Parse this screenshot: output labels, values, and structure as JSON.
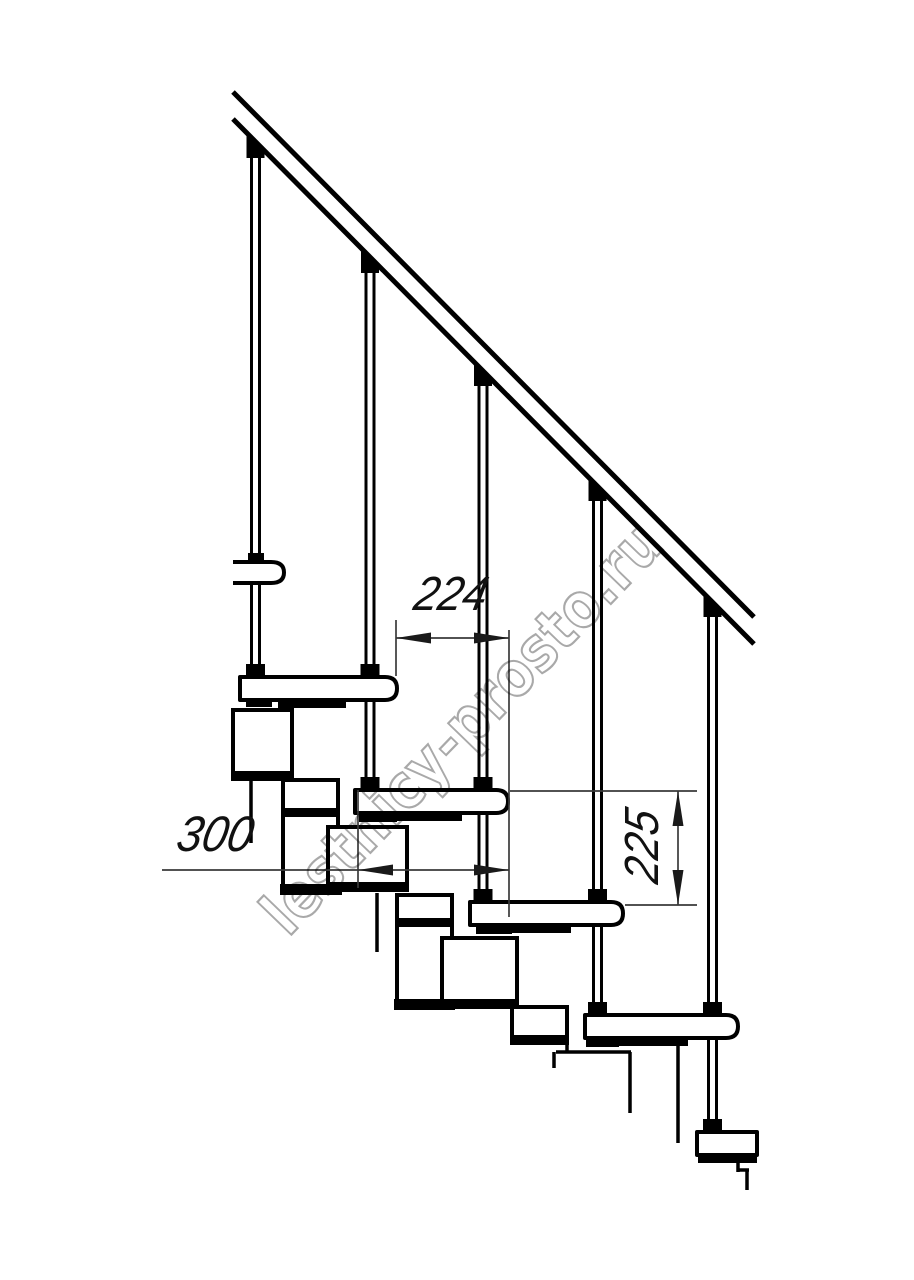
{
  "drawing": {
    "type": "modular-staircase-side-view-technical-drawing",
    "watermark": "lestnicy-prosto.ru",
    "dimensions": {
      "run": "224",
      "depth": "300",
      "rise": "225"
    },
    "colors": {
      "line": "#000000",
      "dimension_line": "#3a3a3a",
      "dimension_text": "#111111",
      "watermark_outline": "#a9a9a9",
      "background": "#ffffff"
    },
    "structure": {
      "treads_visible": 5,
      "balusters_visible": 5
    }
  }
}
